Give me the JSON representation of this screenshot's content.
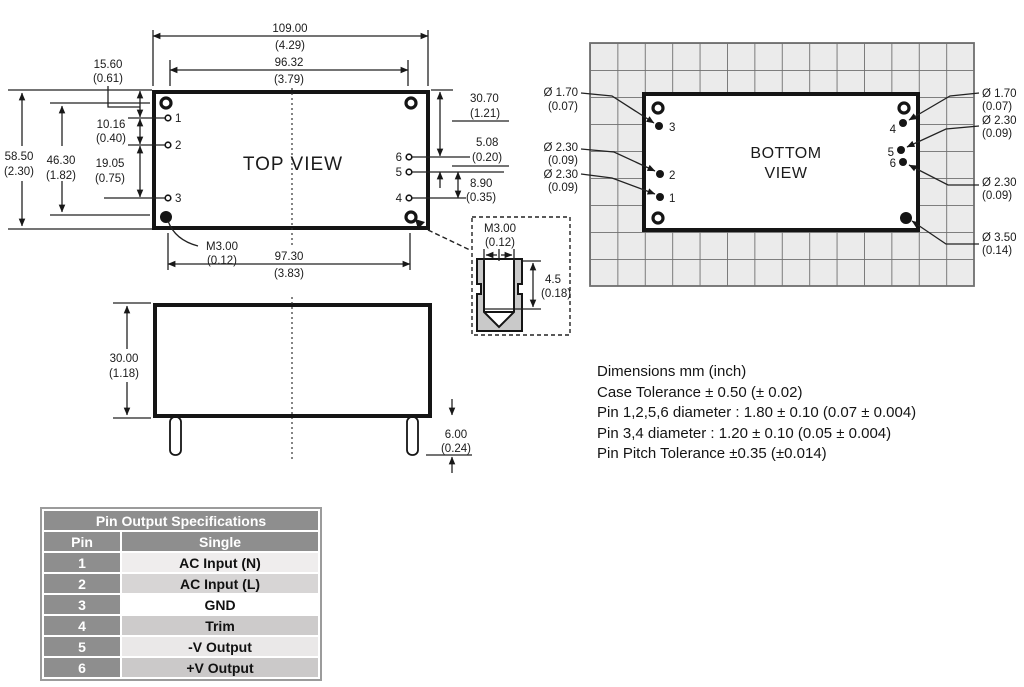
{
  "colors": {
    "table_header_bg": "#8e8e8e",
    "table_header_text": "#ffffff",
    "grid_tile": "#ebebeb",
    "grid_line": "#6f6f6f",
    "insert_fill": "#c9c9c9"
  },
  "top_view": {
    "title": "TOP VIEW",
    "d109_mm": "109.00",
    "d109_in": "(4.29)",
    "d9632_mm": "96.32",
    "d9632_in": "(3.79)",
    "d1560_mm": "15.60",
    "d1560_in": "(0.61)",
    "d1016_mm": "10.16",
    "d1016_in": "(0.40)",
    "d5850_mm": "58.50",
    "d5850_in": "(2.30)",
    "d4630_mm": "46.30",
    "d4630_in": "(1.82)",
    "d1905_mm": "19.05",
    "d1905_in": "(0.75)",
    "d3070_mm": "30.70",
    "d3070_in": "(1.21)",
    "d508_mm": "5.08",
    "d508_in": "(0.20)",
    "d890_mm": "8.90",
    "d890_in": "(0.35)",
    "m3_mm": "M3.00",
    "m3_in": "(0.12)",
    "d9730_mm": "97.30",
    "d9730_in": "(3.83)",
    "pin1": "1",
    "pin2": "2",
    "pin3": "3",
    "pin4": "4",
    "pin5": "5",
    "pin6": "6"
  },
  "side_view": {
    "d3000_mm": "30.00",
    "d3000_in": "(1.18)",
    "d600_mm": "6.00",
    "d600_in": "(0.24)"
  },
  "detail_view": {
    "m3_mm": "M3.00",
    "m3_in": "(0.12)",
    "d45_mm": "4.5",
    "d45_in": "(0.18)"
  },
  "bottom_view": {
    "title1": "BOTTOM",
    "title2": "VIEW",
    "l1_d": "Ø 1.70",
    "l1_i": "(0.07)",
    "l2_d": "Ø 2.30",
    "l2_i": "(0.09)",
    "l3_d": "Ø 2.30",
    "l3_i": "(0.09)",
    "r1_d": "Ø 1.70",
    "r1_i": "(0.07)",
    "r2_d": "Ø 2.30",
    "r2_i": "(0.09)",
    "r3_d": "Ø 2.30",
    "r3_i": "(0.09)",
    "r4_d": "Ø 3.50",
    "r4_i": "(0.14)",
    "pin1": "1",
    "pin2": "2",
    "pin3": "3",
    "pin4": "4",
    "pin5": "5",
    "pin6": "6"
  },
  "notes": [
    "Dimensions mm (inch)",
    "Case Tolerance ± 0.50 (± 0.02)",
    "Pin 1,2,5,6 diameter : 1.80 ± 0.10 (0.07 ± 0.004)",
    "Pin 3,4 diameter : 1.20 ± 0.10 (0.05 ± 0.004)",
    "Pin Pitch Tolerance ±0.35 (±0.014)"
  ],
  "pin_table": {
    "title": "Pin Output Specifications",
    "col_pin": "Pin",
    "col_single": "Single",
    "rows": [
      {
        "pin": "1",
        "value": "AC Input (N)",
        "bg": "#efeded"
      },
      {
        "pin": "2",
        "value": "AC Input (L)",
        "bg": "#d7d5d5"
      },
      {
        "pin": "3",
        "value": "GND",
        "bg": "#ffffff"
      },
      {
        "pin": "4",
        "value": "Trim",
        "bg": "#cdcbcb"
      },
      {
        "pin": "5",
        "value": "-V Output",
        "bg": "#eae8e8"
      },
      {
        "pin": "6",
        "value": "+V Output",
        "bg": "#cbc9c9"
      }
    ]
  }
}
